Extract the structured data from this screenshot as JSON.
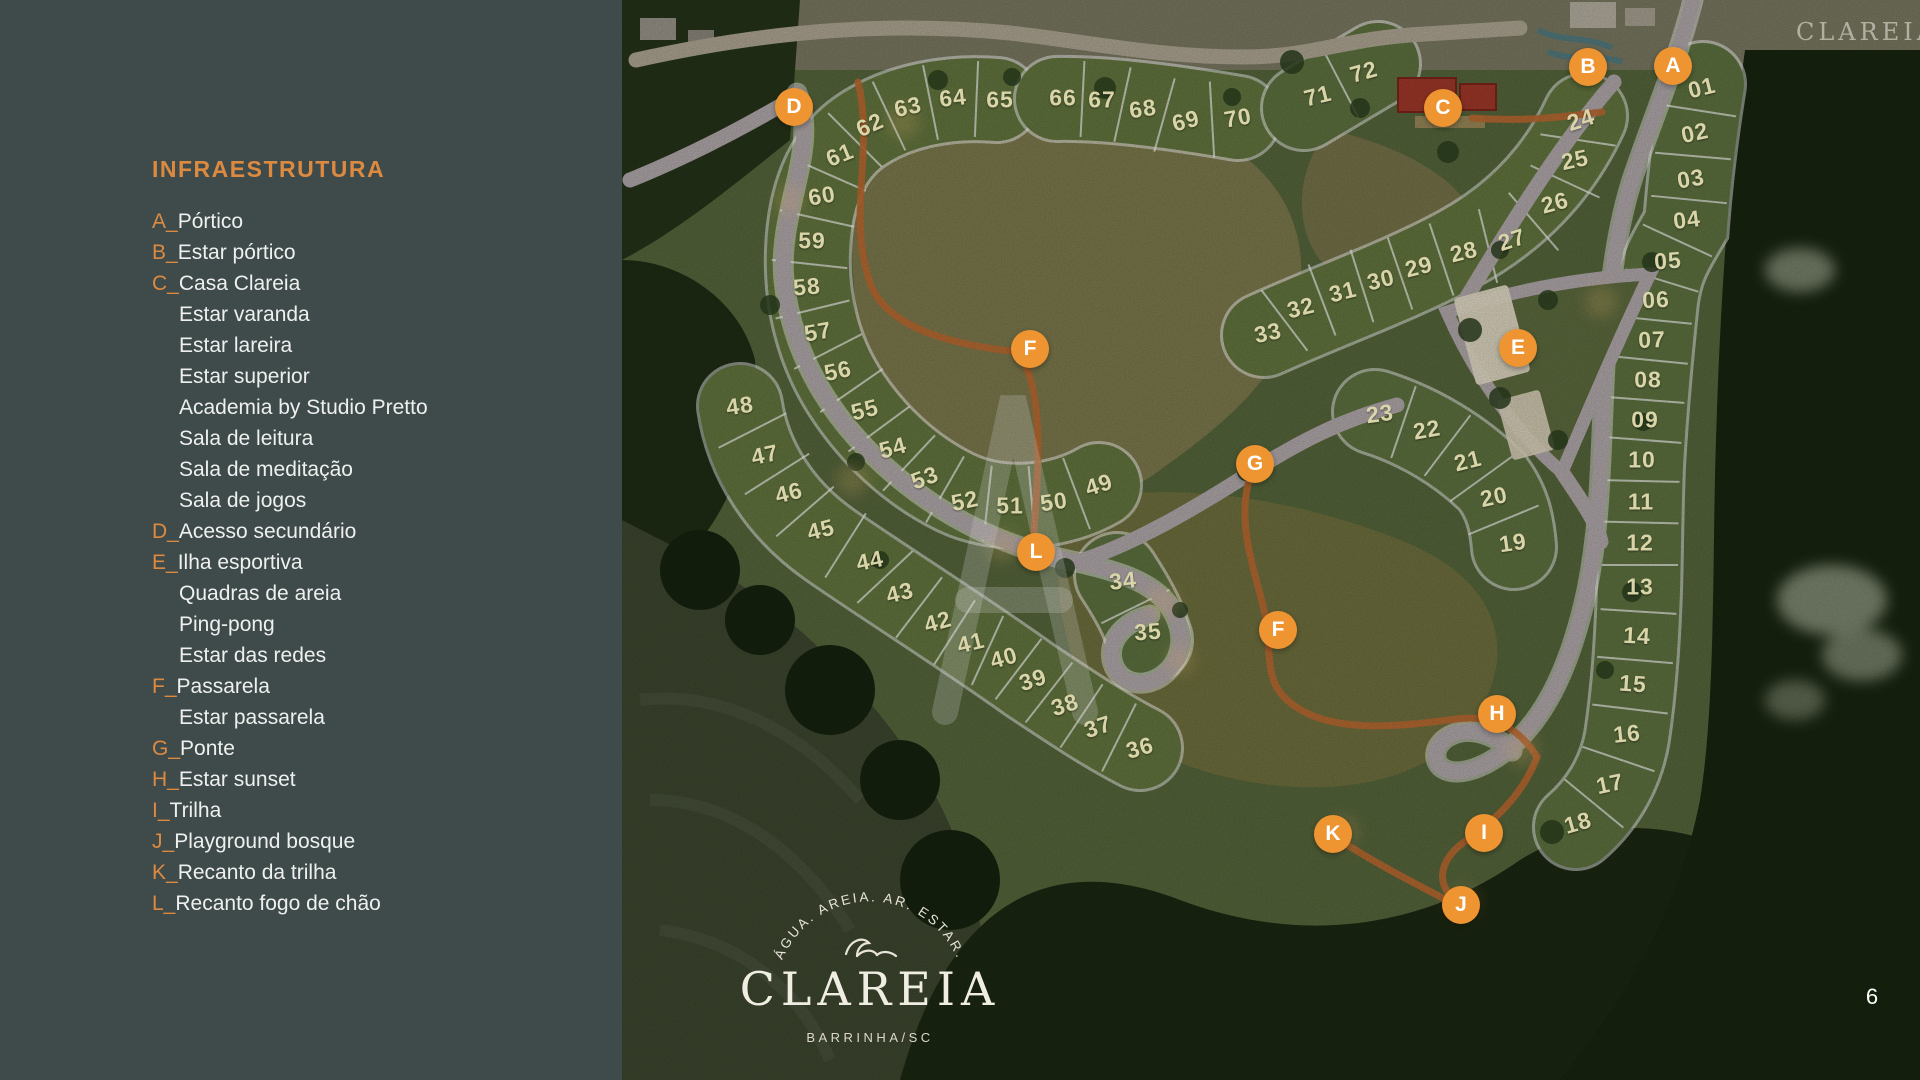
{
  "sidebar": {
    "title": "INFRAESTRUTURA",
    "items": [
      {
        "letter": "A",
        "label": "Pórtico"
      },
      {
        "letter": "B",
        "label": "Estar pórtico"
      },
      {
        "letter": "C",
        "label": "Casa Clareia"
      },
      {
        "label": "Estar varanda"
      },
      {
        "label": "Estar lareira"
      },
      {
        "label": "Estar superior"
      },
      {
        "label": "Academia by Studio Pretto"
      },
      {
        "label": "Sala de leitura"
      },
      {
        "label": "Sala de meditação"
      },
      {
        "label": "Sala de jogos"
      },
      {
        "letter": "D",
        "label": "Acesso secundário"
      },
      {
        "letter": "E",
        "label": "Ilha esportiva"
      },
      {
        "label": "Quadras de areia"
      },
      {
        "label": "Ping-pong"
      },
      {
        "label": "Estar das redes"
      },
      {
        "letter": "F",
        "label": "Passarela"
      },
      {
        "label": "Estar passarela"
      },
      {
        "letter": "G",
        "label": "Ponte"
      },
      {
        "letter": "H",
        "label": "Estar sunset"
      },
      {
        "letter": "I",
        "label": "Trilha"
      },
      {
        "letter": "J",
        "label": "Playground bosque"
      },
      {
        "letter": "K",
        "label": "Recanto da trilha"
      },
      {
        "letter": "L",
        "label": "Recanto fogo de chão"
      }
    ]
  },
  "map": {
    "lots": [
      {
        "n": "01",
        "x": 1702,
        "y": 88,
        "r": -14
      },
      {
        "n": "02",
        "x": 1695,
        "y": 133,
        "r": -12
      },
      {
        "n": "03",
        "x": 1691,
        "y": 179,
        "r": -9
      },
      {
        "n": "04",
        "x": 1687,
        "y": 220,
        "r": -7
      },
      {
        "n": "05",
        "x": 1668,
        "y": 261,
        "r": -4
      },
      {
        "n": "06",
        "x": 1656,
        "y": 300,
        "r": -3
      },
      {
        "n": "07",
        "x": 1652,
        "y": 340,
        "r": -2
      },
      {
        "n": "08",
        "x": 1648,
        "y": 380,
        "r": 0
      },
      {
        "n": "09",
        "x": 1645,
        "y": 420,
        "r": 0
      },
      {
        "n": "10",
        "x": 1642,
        "y": 460,
        "r": 0
      },
      {
        "n": "11",
        "x": 1641,
        "y": 502,
        "r": 0
      },
      {
        "n": "12",
        "x": 1640,
        "y": 543,
        "r": 0
      },
      {
        "n": "13",
        "x": 1640,
        "y": 587,
        "r": 0
      },
      {
        "n": "14",
        "x": 1637,
        "y": 636,
        "r": 3
      },
      {
        "n": "15",
        "x": 1633,
        "y": 684,
        "r": 4
      },
      {
        "n": "16",
        "x": 1627,
        "y": 734,
        "r": -6
      },
      {
        "n": "17",
        "x": 1610,
        "y": 784,
        "r": -12
      },
      {
        "n": "18",
        "x": 1578,
        "y": 823,
        "r": -16
      },
      {
        "n": "19",
        "x": 1513,
        "y": 543,
        "r": -8
      },
      {
        "n": "20",
        "x": 1494,
        "y": 497,
        "r": -12
      },
      {
        "n": "21",
        "x": 1468,
        "y": 461,
        "r": -14
      },
      {
        "n": "22",
        "x": 1427,
        "y": 430,
        "r": -10
      },
      {
        "n": "23",
        "x": 1380,
        "y": 414,
        "r": -8
      },
      {
        "n": "24",
        "x": 1581,
        "y": 120,
        "r": -18
      },
      {
        "n": "25",
        "x": 1575,
        "y": 160,
        "r": -12
      },
      {
        "n": "26",
        "x": 1555,
        "y": 203,
        "r": -15
      },
      {
        "n": "27",
        "x": 1512,
        "y": 240,
        "r": -18
      },
      {
        "n": "28",
        "x": 1464,
        "y": 252,
        "r": -14
      },
      {
        "n": "29",
        "x": 1419,
        "y": 267,
        "r": -14
      },
      {
        "n": "30",
        "x": 1381,
        "y": 280,
        "r": -14
      },
      {
        "n": "31",
        "x": 1343,
        "y": 292,
        "r": -14
      },
      {
        "n": "32",
        "x": 1301,
        "y": 308,
        "r": -14
      },
      {
        "n": "33",
        "x": 1268,
        "y": 333,
        "r": -12
      },
      {
        "n": "34",
        "x": 1123,
        "y": 581,
        "r": -6
      },
      {
        "n": "35",
        "x": 1148,
        "y": 632,
        "r": -4
      },
      {
        "n": "36",
        "x": 1140,
        "y": 748,
        "r": -16
      },
      {
        "n": "37",
        "x": 1098,
        "y": 727,
        "r": -18
      },
      {
        "n": "38",
        "x": 1065,
        "y": 705,
        "r": -18
      },
      {
        "n": "39",
        "x": 1033,
        "y": 680,
        "r": -18
      },
      {
        "n": "40",
        "x": 1004,
        "y": 658,
        "r": -16
      },
      {
        "n": "41",
        "x": 971,
        "y": 643,
        "r": -14
      },
      {
        "n": "42",
        "x": 938,
        "y": 622,
        "r": -16
      },
      {
        "n": "43",
        "x": 900,
        "y": 593,
        "r": -14
      },
      {
        "n": "44",
        "x": 870,
        "y": 561,
        "r": -12
      },
      {
        "n": "45",
        "x": 821,
        "y": 530,
        "r": -14
      },
      {
        "n": "46",
        "x": 789,
        "y": 493,
        "r": -14
      },
      {
        "n": "47",
        "x": 765,
        "y": 455,
        "r": -12
      },
      {
        "n": "48",
        "x": 740,
        "y": 406,
        "r": -8
      },
      {
        "n": "49",
        "x": 1099,
        "y": 485,
        "r": -18
      },
      {
        "n": "50",
        "x": 1054,
        "y": 502,
        "r": -8
      },
      {
        "n": "51",
        "x": 1010,
        "y": 506,
        "r": 0
      },
      {
        "n": "52",
        "x": 965,
        "y": 501,
        "r": -12
      },
      {
        "n": "53",
        "x": 925,
        "y": 478,
        "r": -20
      },
      {
        "n": "54",
        "x": 893,
        "y": 448,
        "r": -15
      },
      {
        "n": "55",
        "x": 865,
        "y": 410,
        "r": -14
      },
      {
        "n": "56",
        "x": 838,
        "y": 371,
        "r": -12
      },
      {
        "n": "57",
        "x": 818,
        "y": 332,
        "r": -10
      },
      {
        "n": "58",
        "x": 807,
        "y": 287,
        "r": -5
      },
      {
        "n": "59",
        "x": 812,
        "y": 241,
        "r": 0
      },
      {
        "n": "60",
        "x": 822,
        "y": 196,
        "r": -10
      },
      {
        "n": "61",
        "x": 840,
        "y": 155,
        "r": -22
      },
      {
        "n": "62",
        "x": 870,
        "y": 125,
        "r": -24
      },
      {
        "n": "63",
        "x": 908,
        "y": 107,
        "r": -12
      },
      {
        "n": "64",
        "x": 953,
        "y": 98,
        "r": -6
      },
      {
        "n": "65",
        "x": 1000,
        "y": 100,
        "r": 0
      },
      {
        "n": "66",
        "x": 1063,
        "y": 98,
        "r": 0
      },
      {
        "n": "67",
        "x": 1102,
        "y": 100,
        "r": 0
      },
      {
        "n": "68",
        "x": 1143,
        "y": 109,
        "r": -8
      },
      {
        "n": "69",
        "x": 1186,
        "y": 121,
        "r": -14
      },
      {
        "n": "70",
        "x": 1238,
        "y": 118,
        "r": -10
      },
      {
        "n": "71",
        "x": 1318,
        "y": 96,
        "r": -14
      },
      {
        "n": "72",
        "x": 1364,
        "y": 72,
        "r": -16
      }
    ],
    "markers": [
      {
        "letter": "A",
        "x": 1673,
        "y": 66
      },
      {
        "letter": "B",
        "x": 1588,
        "y": 67
      },
      {
        "letter": "C",
        "x": 1443,
        "y": 108
      },
      {
        "letter": "D",
        "x": 794,
        "y": 107
      },
      {
        "letter": "E",
        "x": 1518,
        "y": 348
      },
      {
        "letter": "F",
        "x": 1030,
        "y": 349
      },
      {
        "letter": "G",
        "x": 1255,
        "y": 464
      },
      {
        "letter": "F",
        "x": 1278,
        "y": 630
      },
      {
        "letter": "H",
        "x": 1497,
        "y": 714
      },
      {
        "letter": "K",
        "x": 1333,
        "y": 834
      },
      {
        "letter": "I",
        "x": 1484,
        "y": 833
      },
      {
        "letter": "J",
        "x": 1461,
        "y": 905
      },
      {
        "letter": "L",
        "x": 1036,
        "y": 552
      }
    ],
    "divider_chains": [
      [
        "65",
        "64",
        "63",
        "62",
        "61",
        "60",
        "59",
        "58",
        "57",
        "56",
        "55",
        "54",
        "53",
        "52",
        "51",
        "50",
        "49"
      ],
      [
        "66",
        "67",
        "68",
        "69",
        "70"
      ],
      [
        "71",
        "72"
      ],
      [
        "48",
        "47",
        "46",
        "45",
        "44",
        "43",
        "42",
        "41",
        "40",
        "39",
        "38",
        "37",
        "36"
      ],
      [
        "34",
        "35"
      ],
      [
        "24",
        "25",
        "26",
        "27",
        "28",
        "29",
        "30",
        "31",
        "32",
        "33"
      ],
      [
        "23",
        "22",
        "21",
        "20",
        "19"
      ],
      [
        "01",
        "02",
        "03",
        "04",
        "05",
        "06",
        "07",
        "08",
        "09",
        "10",
        "11",
        "12",
        "13",
        "14",
        "15",
        "16",
        "17",
        "18"
      ]
    ]
  },
  "logo": {
    "tagline_arc": "ÁGUA. AREIA. AR. ESTAR.",
    "wordmark": "CLAREIA",
    "location": "BARRINHA/SC"
  },
  "corner_watermark": "CLAREIA",
  "page_number": "6",
  "colors": {
    "sidebar_bg": "#3f4a4b",
    "accent_orange": "#dd8a41",
    "marker_orange": "#ee9531",
    "lot_number": "#d9d5a8",
    "text_white": "#eef0ee",
    "lot_green": "#64773f",
    "road": "#b3aaac",
    "trail_orange": "#bd6a31"
  }
}
